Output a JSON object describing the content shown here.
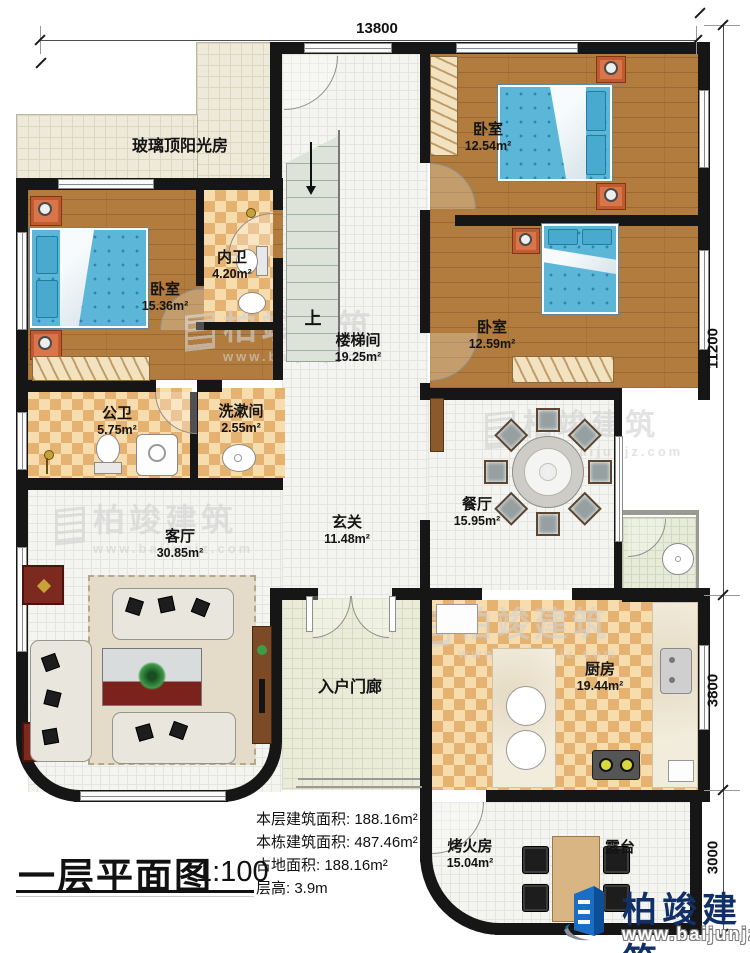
{
  "plan": {
    "dimensions": {
      "top": "13800",
      "right": [
        "11200",
        "3800",
        "3000"
      ]
    },
    "rooms": {
      "sunroom": {
        "name": "玻璃顶阳光房"
      },
      "bedroom_tr": {
        "name": "卧室",
        "area": "12.54m²"
      },
      "bedroom_l": {
        "name": "卧室",
        "area": "15.36m²"
      },
      "inner_bath": {
        "name": "内卫",
        "area": "4.20m²"
      },
      "stairwell": {
        "name": "楼梯间",
        "area": "19.25m²",
        "up": "上"
      },
      "bedroom_mr": {
        "name": "卧室",
        "area": "12.59m²"
      },
      "public_bath": {
        "name": "公卫",
        "area": "5.75m²"
      },
      "washroom": {
        "name": "洗漱间",
        "area": "2.55m²"
      },
      "dining": {
        "name": "餐厅",
        "area": "15.95m²"
      },
      "foyer": {
        "name": "玄关",
        "area": "11.48m²"
      },
      "living": {
        "name": "客厅",
        "area": "30.85m²"
      },
      "porch": {
        "name": "入户门廊"
      },
      "kitchen": {
        "name": "厨房",
        "area": "19.44m²"
      },
      "fire_room": {
        "name": "烤火房",
        "area": "15.04m²"
      },
      "terrace": {
        "name": "露台"
      }
    },
    "title_block": {
      "title": "一层平面图",
      "scale": "1:100",
      "stats": [
        "本层建筑面积: 188.16m²",
        "本栋建筑面积: 487.46m²",
        "占地面积: 188.16m²",
        "层高: 3.9m"
      ]
    },
    "branding": {
      "logo_text": "柏竣建筑",
      "logo_url": "www.baijunjz.com",
      "watermark_text": "柏竣建筑",
      "watermark_url": "www.baijunjz.com"
    }
  }
}
